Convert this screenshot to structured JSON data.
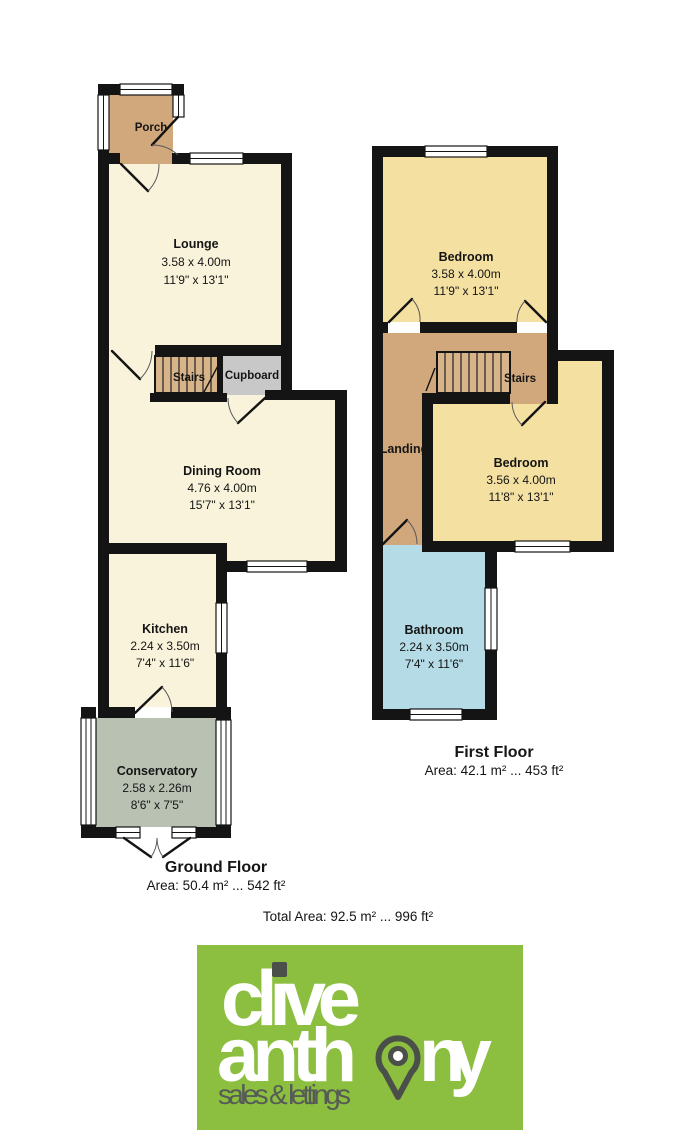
{
  "floorplan": {
    "ground_floor": {
      "title": "Ground Floor",
      "area": "Area: 50.4 m² ... 542 ft²",
      "rooms": {
        "porch": {
          "name": "Porch"
        },
        "lounge": {
          "name": "Lounge",
          "dim_m": "3.58 x 4.00m",
          "dim_ft": "11'9\" x 13'1\""
        },
        "stairs": {
          "name": "Stairs"
        },
        "cupboard": {
          "name": "Cupboard"
        },
        "dining": {
          "name": "Dining Room",
          "dim_m": "4.76 x 4.00m",
          "dim_ft": "15'7\" x 13'1\""
        },
        "kitchen": {
          "name": "Kitchen",
          "dim_m": "2.24 x 3.50m",
          "dim_ft": "7'4\" x 11'6\""
        },
        "conservatory": {
          "name": "Conservatory",
          "dim_m": "2.58 x 2.26m",
          "dim_ft": "8'6\" x 7'5\""
        }
      }
    },
    "first_floor": {
      "title": "First Floor",
      "area": "Area: 42.1 m² ... 453 ft²",
      "rooms": {
        "bedroom_front": {
          "name": "Bedroom",
          "dim_m": "3.58 x 4.00m",
          "dim_ft": "11'9\" x 13'1\""
        },
        "stairs": {
          "name": "Stairs"
        },
        "landing": {
          "name": "Landing"
        },
        "bedroom_back": {
          "name": "Bedroom",
          "dim_m": "3.56 x 4.00m",
          "dim_ft": "11'8\" x 13'1\""
        },
        "bathroom": {
          "name": "Bathroom",
          "dim_m": "2.24 x 3.50m",
          "dim_ft": "7'4\" x 11'6\""
        }
      }
    },
    "total_area": "Total Area: 92.5 m² ... 996 ft²"
  },
  "logo": {
    "word1": "clive",
    "word2": "anthony",
    "word2_before_pin": "anth",
    "word2_after_pin": "ny",
    "tagline": "sales & lettings"
  },
  "colors": {
    "wall": "#141414",
    "room_cream": "#f8f3da",
    "room_yellow": "#f4e0a1",
    "room_blue": "#b4dbe6",
    "room_tan": "#d1a77c",
    "stairs_tread": "#d8b48b",
    "cupboard_gray": "#c8c8c8",
    "conservatory_green": "#b8c1b2",
    "brand_green": "#8cbe3f",
    "brand_dark": "#4b4f49",
    "brand_white": "#ffffff",
    "brand_gray_text": "#565b56"
  }
}
